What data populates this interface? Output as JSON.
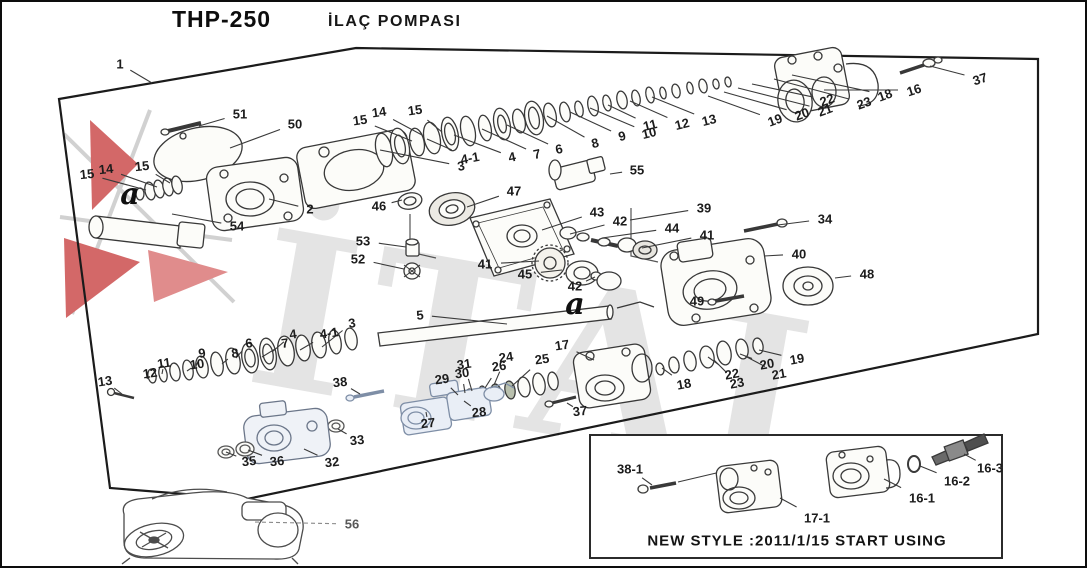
{
  "title": {
    "model": "THP-250",
    "name": "İLAÇ POMPASI"
  },
  "watermark": {
    "text": "İTAL"
  },
  "colors": {
    "ink": "#1c1c1c",
    "leader": "#3a3a3a",
    "frame": "#1b1b1b",
    "watermark_gray": "#e2e2e2",
    "logo_red": "#c94343",
    "blue_part_fill": "#e9eef6",
    "blue_part_stroke": "#7e8ea6"
  },
  "callouts": [
    {
      "t": "1",
      "x": 118,
      "y": 62,
      "lx": 150,
      "ly": 81
    },
    {
      "t": "51",
      "x": 238,
      "y": 112,
      "lx": 197,
      "ly": 124
    },
    {
      "t": "50",
      "x": 293,
      "y": 122,
      "lx": 228,
      "ly": 146
    },
    {
      "t": "14",
      "x": 377,
      "y": 110,
      "lx": 420,
      "ly": 133,
      "r": -8
    },
    {
      "t": "15",
      "x": 413,
      "y": 108,
      "lx": 440,
      "ly": 130,
      "r": -8
    },
    {
      "t": "15",
      "x": 358,
      "y": 118,
      "lx": 410,
      "ly": 139,
      "r": -8
    },
    {
      "t": "15",
      "x": 85,
      "y": 172,
      "lx": 144,
      "ly": 188,
      "r": -6
    },
    {
      "t": "14",
      "x": 104,
      "y": 167,
      "lx": 155,
      "ly": 185,
      "r": -6
    },
    {
      "t": "15",
      "x": 140,
      "y": 164,
      "lx": 168,
      "ly": 181,
      "r": -6
    },
    {
      "t": "54",
      "x": 235,
      "y": 224,
      "lx": 170,
      "ly": 212
    },
    {
      "t": "2",
      "x": 308,
      "y": 207,
      "lx": 267,
      "ly": 197
    },
    {
      "t": "3",
      "x": 459,
      "y": 164,
      "lx": 378,
      "ly": 148,
      "r": -10
    },
    {
      "t": "4-1",
      "x": 468,
      "y": 156,
      "lx": 425,
      "ly": 137,
      "r": -10
    },
    {
      "t": "4",
      "x": 510,
      "y": 155,
      "lx": 452,
      "ly": 133,
      "r": -12
    },
    {
      "t": "7",
      "x": 535,
      "y": 152,
      "lx": 480,
      "ly": 127,
      "r": -12
    },
    {
      "t": "6",
      "x": 557,
      "y": 147,
      "lx": 505,
      "ly": 123,
      "r": -12
    },
    {
      "t": "8",
      "x": 593,
      "y": 141,
      "lx": 545,
      "ly": 114,
      "r": -14
    },
    {
      "t": "9",
      "x": 620,
      "y": 134,
      "lx": 568,
      "ly": 110,
      "r": -14
    },
    {
      "t": "10",
      "x": 647,
      "y": 131,
      "lx": 588,
      "ly": 106,
      "r": -14
    },
    {
      "t": "11",
      "x": 648,
      "y": 123,
      "lx": 606,
      "ly": 103,
      "r": -14
    },
    {
      "t": "12",
      "x": 680,
      "y": 122,
      "lx": 628,
      "ly": 99,
      "r": -14
    },
    {
      "t": "13",
      "x": 707,
      "y": 118,
      "lx": 650,
      "ly": 95,
      "r": -14
    },
    {
      "t": "19",
      "x": 773,
      "y": 118,
      "lx": 706,
      "ly": 94,
      "r": -20
    },
    {
      "t": "20",
      "x": 800,
      "y": 112,
      "lx": 722,
      "ly": 90,
      "r": -20
    },
    {
      "t": "21",
      "x": 823,
      "y": 108,
      "lx": 736,
      "ly": 86,
      "r": -20
    },
    {
      "t": "22",
      "x": 825,
      "y": 98,
      "lx": 750,
      "ly": 82,
      "r": -20
    },
    {
      "t": "23",
      "x": 862,
      "y": 101,
      "lx": 772,
      "ly": 77,
      "r": -20
    },
    {
      "t": "18",
      "x": 883,
      "y": 93,
      "lx": 790,
      "ly": 73,
      "r": -20
    },
    {
      "t": "16",
      "x": 912,
      "y": 88,
      "lx": 822,
      "ly": 88,
      "r": -18
    },
    {
      "t": "37",
      "x": 978,
      "y": 77,
      "lx": 928,
      "ly": 64,
      "r": -18
    },
    {
      "t": "55",
      "x": 635,
      "y": 168,
      "lx": 608,
      "ly": 172
    },
    {
      "t": "47",
      "x": 512,
      "y": 189,
      "lx": 465,
      "ly": 205
    },
    {
      "t": "46",
      "x": 377,
      "y": 204,
      "lx": 400,
      "ly": 198
    },
    {
      "t": "43",
      "x": 595,
      "y": 210,
      "lx": 540,
      "ly": 228
    },
    {
      "t": "42",
      "x": 618,
      "y": 219,
      "lx": 568,
      "ly": 232
    },
    {
      "t": "44",
      "x": 670,
      "y": 226,
      "lx": 600,
      "ly": 236
    },
    {
      "t": "41",
      "x": 705,
      "y": 233,
      "lx": 640,
      "ly": 246
    },
    {
      "t": "39",
      "x": 702,
      "y": 206,
      "lx": 628,
      "ly": 218
    },
    {
      "t": "34",
      "x": 823,
      "y": 217,
      "lx": 768,
      "ly": 224
    },
    {
      "t": "40",
      "x": 797,
      "y": 252,
      "lx": 762,
      "ly": 254
    },
    {
      "t": "48",
      "x": 865,
      "y": 272,
      "lx": 833,
      "ly": 276
    },
    {
      "t": "49",
      "x": 695,
      "y": 299,
      "lx": 733,
      "ly": 296
    },
    {
      "t": "53",
      "x": 361,
      "y": 239,
      "lx": 404,
      "ly": 245
    },
    {
      "t": "52",
      "x": 356,
      "y": 257,
      "lx": 402,
      "ly": 267
    },
    {
      "t": "41",
      "x": 483,
      "y": 262,
      "lx": 537,
      "ly": 259
    },
    {
      "t": "45",
      "x": 523,
      "y": 272,
      "lx": 560,
      "ly": 268
    },
    {
      "t": "42",
      "x": 573,
      "y": 284,
      "lx": 593,
      "ly": 275
    },
    {
      "t": "5",
      "x": 418,
      "y": 313,
      "lx": 505,
      "ly": 322,
      "r": -6
    },
    {
      "t": "3",
      "x": 350,
      "y": 321,
      "lx": 320,
      "ly": 345,
      "r": -8
    },
    {
      "t": "4-1",
      "x": 327,
      "y": 331,
      "lx": 298,
      "ly": 348,
      "r": -8
    },
    {
      "t": "4",
      "x": 291,
      "y": 332,
      "lx": 270,
      "ly": 350,
      "r": -8
    },
    {
      "t": "7",
      "x": 283,
      "y": 341,
      "lx": 260,
      "ly": 355,
      "r": -8
    },
    {
      "t": "6",
      "x": 247,
      "y": 341,
      "lx": 234,
      "ly": 356,
      "r": -8
    },
    {
      "t": "8",
      "x": 233,
      "y": 351,
      "lx": 220,
      "ly": 362,
      "r": -8
    },
    {
      "t": "9",
      "x": 200,
      "y": 351,
      "lx": 194,
      "ly": 364,
      "r": -8
    },
    {
      "t": "10",
      "x": 195,
      "y": 362,
      "lx": 185,
      "ly": 369,
      "r": -8
    },
    {
      "t": "11",
      "x": 162,
      "y": 361,
      "lx": 160,
      "ly": 372,
      "r": -8
    },
    {
      "t": "12",
      "x": 148,
      "y": 371,
      "lx": 145,
      "ly": 377,
      "r": -8
    },
    {
      "t": "13",
      "x": 103,
      "y": 379,
      "lx": 120,
      "ly": 392,
      "r": -8
    },
    {
      "t": "38",
      "x": 338,
      "y": 380,
      "lx": 358,
      "ly": 392,
      "r": -6
    },
    {
      "t": "29",
      "x": 440,
      "y": 377,
      "lx": 456,
      "ly": 393,
      "r": -8
    },
    {
      "t": "30",
      "x": 460,
      "y": 371,
      "lx": 463,
      "ly": 391,
      "r": -8
    },
    {
      "t": "31",
      "x": 462,
      "y": 362,
      "lx": 470,
      "ly": 389,
      "r": -8
    },
    {
      "t": "26",
      "x": 497,
      "y": 364,
      "lx": 483,
      "ly": 386,
      "r": -8
    },
    {
      "t": "24",
      "x": 504,
      "y": 355,
      "lx": 492,
      "ly": 383,
      "r": -8
    },
    {
      "t": "25",
      "x": 540,
      "y": 357,
      "lx": 510,
      "ly": 384,
      "r": -8
    },
    {
      "t": "17",
      "x": 560,
      "y": 343,
      "lx": 592,
      "ly": 358,
      "r": -8
    },
    {
      "t": "18",
      "x": 682,
      "y": 382,
      "lx": 660,
      "ly": 366,
      "r": -10
    },
    {
      "t": "23",
      "x": 735,
      "y": 381,
      "lx": 712,
      "ly": 358,
      "r": -10
    },
    {
      "t": "22",
      "x": 730,
      "y": 372,
      "lx": 706,
      "ly": 355,
      "r": -10
    },
    {
      "t": "21",
      "x": 777,
      "y": 372,
      "lx": 743,
      "ly": 354,
      "r": -10
    },
    {
      "t": "20",
      "x": 765,
      "y": 362,
      "lx": 738,
      "ly": 352,
      "r": -10
    },
    {
      "t": "19",
      "x": 795,
      "y": 357,
      "lx": 757,
      "ly": 348,
      "r": -10
    },
    {
      "t": "28",
      "x": 477,
      "y": 410,
      "lx": 462,
      "ly": 399,
      "r": -6
    },
    {
      "t": "27",
      "x": 426,
      "y": 421,
      "lx": 424,
      "ly": 410,
      "r": -6
    },
    {
      "t": "37",
      "x": 578,
      "y": 409,
      "lx": 565,
      "ly": 401,
      "r": -6
    },
    {
      "t": "33",
      "x": 355,
      "y": 438,
      "lx": 336,
      "ly": 427,
      "r": -6
    },
    {
      "t": "32",
      "x": 330,
      "y": 460,
      "lx": 302,
      "ly": 447,
      "r": -6
    },
    {
      "t": "36",
      "x": 275,
      "y": 459,
      "lx": 246,
      "ly": 448,
      "r": -6
    },
    {
      "t": "35",
      "x": 247,
      "y": 459,
      "lx": 224,
      "ly": 450,
      "r": -6
    },
    {
      "t": "56",
      "x": 350,
      "y": 522,
      "lx": 252,
      "ly": 520,
      "dash": true,
      "muted": true
    }
  ],
  "zone_letters": [
    {
      "t": "a",
      "x": 128,
      "y": 193
    },
    {
      "t": "a",
      "x": 573,
      "y": 303
    }
  ],
  "inset": {
    "caption": "NEW STYLE :2011/1/15 START USING",
    "callouts": [
      {
        "t": "38-1",
        "x": 628,
        "y": 467,
        "lx": 650,
        "ly": 483
      },
      {
        "t": "17-1",
        "x": 815,
        "y": 516,
        "lx": 778,
        "ly": 496
      },
      {
        "t": "16-1",
        "x": 920,
        "y": 496,
        "lx": 882,
        "ly": 477
      },
      {
        "t": "16-2",
        "x": 955,
        "y": 479,
        "lx": 918,
        "ly": 464
      },
      {
        "t": "16-3",
        "x": 988,
        "y": 466,
        "lx": 962,
        "ly": 452
      }
    ]
  }
}
